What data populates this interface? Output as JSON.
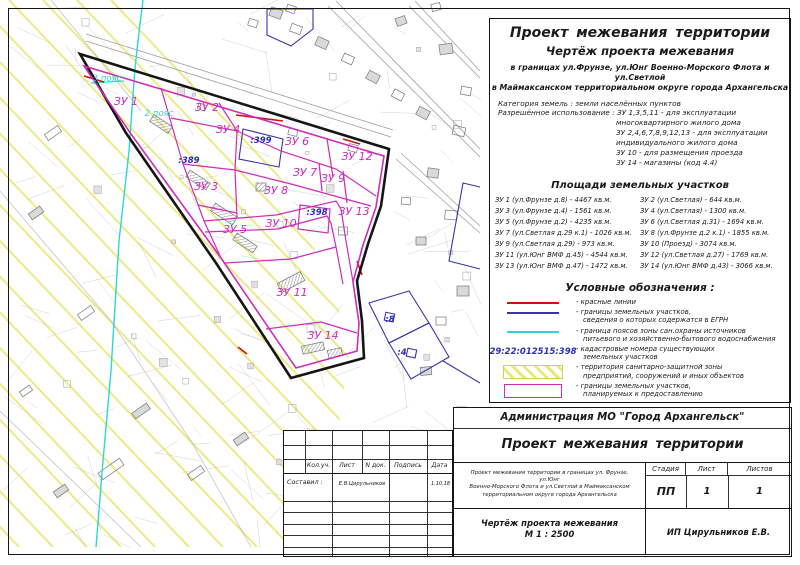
{
  "colors": {
    "magenta": "#cc2db8",
    "blue": "#3a35a8",
    "cyan": "#2fd6d6",
    "red": "#cc1111",
    "yellow": "#e9e97a",
    "cad_blue": "#2a2fb5"
  },
  "header": {
    "title": "Проект межевания территории",
    "subtitle": "Чертёж проекта межевания",
    "addr1": "в границах ул.Фрунзе, ул.Юнг Военно-Морского Флота и ул.Светлой",
    "addr2": "в Маймаксанском территориальном округе города Архангельска",
    "category": "Категория земель : земли населённых пунктов",
    "permitted": [
      "Разрешённое использование : ЗУ 1,3,5,11 - для эксплуатации",
      "многоквартирного жилого дома",
      "ЗУ 2,4,6,7,8,9,12,13 - для эксплуатации",
      "индивидуального жилого дома",
      "ЗУ 10 - для размещения проезда",
      "ЗУ 14 - магазины (код 4.4)"
    ]
  },
  "areas": {
    "title": "Площади земельных участков",
    "left": [
      "ЗУ 1 (ул.Фрунзе д.8) - 4467 кв.м.",
      "ЗУ 3 (ул.Фрунзе д.4) - 1561 кв.м.",
      "ЗУ 5 (ул.Фрунзе д.2) - 4235 кв.м.",
      "ЗУ 7 (ул.Светлая д.29 к.1) - 1026 кв.м.",
      "ЗУ 9 (ул.Светлая д.29) - 973 кв.м.",
      "ЗУ 11 (ул.Юнг ВМФ д.45) - 4544 кв.м.",
      "ЗУ 13 (ул.Юнг ВМФ д.47) - 1472 кв.м."
    ],
    "right": [
      "ЗУ 2 (ул.Светлая) - 644 кв.м.",
      "ЗУ 4 (ул.Светлая) - 1300 кв.м.",
      "ЗУ 6 (ул.Светлая д.31) - 1694 кв.м.",
      "ЗУ 8 (ул.Фрунзе д.2 к.1) - 1855 кв.м.",
      "ЗУ 10 (Проезд) - 3074 кв.м.",
      "ЗУ 12 (ул.Светлая д.27) - 1769 кв.м.",
      "ЗУ 14 (ул.Юнг ВМФ д.43) - 3066 кв.м."
    ]
  },
  "legend": {
    "title": "Условные обозначения :",
    "items": [
      {
        "swatch": "line",
        "color_key": "red",
        "lines": [
          "- красные линии"
        ]
      },
      {
        "swatch": "line",
        "color_key": "blue",
        "lines": [
          "- границы земельных участков,",
          "сведения о которых содержатся в ЕГРН"
        ]
      },
      {
        "swatch": "line",
        "color_key": "cyan",
        "lines": [
          "- граница поясов зоны сан.охраны источников",
          "питьевого и хозяйственно-бытового  водоснабжения"
        ]
      },
      {
        "swatch": "cad",
        "label": "29:22:012515:398",
        "lines": [
          "- кадастровые номера существующих",
          "земельных участков"
        ]
      },
      {
        "swatch": "yellow",
        "lines": [
          "- территория санитарно-защитной зоны",
          "предприятий, сооружений и иных объектов"
        ]
      },
      {
        "swatch": "magenta",
        "lines": [
          "- границы земельных участков,",
          "планируемых к предоставлению"
        ]
      }
    ]
  },
  "titleblock": {
    "org": "Администрация МО \"Город Архангельск\"",
    "project": "Проект межевания территории",
    "cols": [
      "Кол.уч.",
      "Лист",
      "N док.",
      "Подпись",
      "Дата"
    ],
    "made_label": "Составил :",
    "made_by": "Е.В.Цирульников",
    "date": "1.10.18",
    "desc": [
      "Проект межевания территории в границах ул. Фрунзе, ул.Юнг",
      "Военно-Морского Флота и ул.Светлой в Маймаксанском",
      "территориальном округе города Архангельска"
    ],
    "stage_label": "Стадия",
    "sheet_label": "Лист",
    "sheets_label": "Листов",
    "stage": "ПП",
    "sheet": "1",
    "sheets": "1",
    "drawing": "Чертёж проекта межевания",
    "scale": "М 1 : 2500",
    "firm": "ИП Цирульников Е.В."
  },
  "map": {
    "labels": [
      {
        "id": "zu1",
        "text": "ЗУ 1",
        "kind": "parcel"
      },
      {
        "id": "zu2",
        "text": "ЗУ 2",
        "kind": "parcel"
      },
      {
        "id": "zu3",
        "text": "ЗУ 3",
        "kind": "parcel"
      },
      {
        "id": "zu4",
        "text": "ЗУ 4",
        "kind": "parcel"
      },
      {
        "id": "zu5",
        "text": "ЗУ 5",
        "kind": "parcel"
      },
      {
        "id": "zu6",
        "text": "ЗУ 6",
        "kind": "parcel"
      },
      {
        "id": "zu7",
        "text": "ЗУ 7",
        "kind": "parcel"
      },
      {
        "id": "zu8",
        "text": "ЗУ 8",
        "kind": "parcel"
      },
      {
        "id": "zu9",
        "text": "ЗУ 9",
        "kind": "parcel"
      },
      {
        "id": "zu10",
        "text": "ЗУ 10",
        "kind": "parcel"
      },
      {
        "id": "zu11",
        "text": "ЗУ 11",
        "kind": "parcel"
      },
      {
        "id": "zu12",
        "text": "ЗУ 12",
        "kind": "parcel"
      },
      {
        "id": "zu13",
        "text": "ЗУ 13",
        "kind": "parcel"
      },
      {
        "id": "zu14",
        "text": "ЗУ 14",
        "kind": "parcel"
      },
      {
        "id": "cad399",
        "text": ":399",
        "kind": "cad"
      },
      {
        "id": "cad389",
        "text": ":389",
        "kind": "cad"
      },
      {
        "id": "cad398",
        "text": ":398",
        "kind": "cad"
      },
      {
        "id": "cad8",
        "text": ":8",
        "kind": "cad"
      },
      {
        "id": "cad4",
        "text": ":4",
        "kind": "cad"
      },
      {
        "id": "zone3",
        "text": "3 пояс",
        "kind": "zone"
      },
      {
        "id": "zone2",
        "text": "2 пояс",
        "kind": "zone"
      }
    ]
  }
}
